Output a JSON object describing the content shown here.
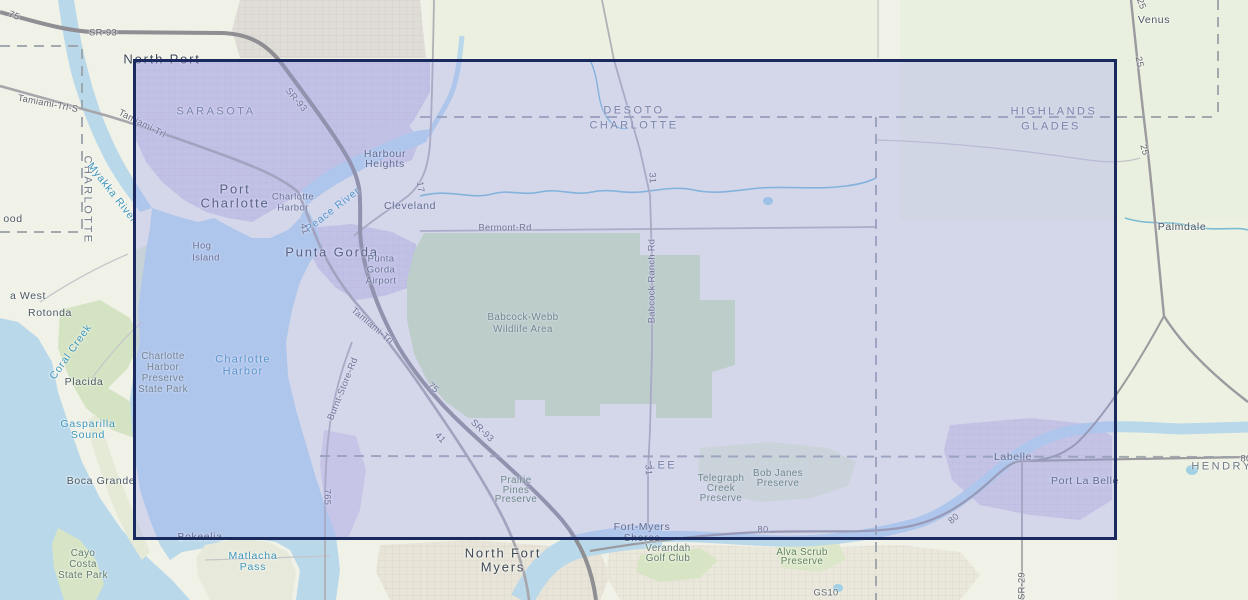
{
  "map": {
    "region": "Charlotte Harbor / Punta Gorda, Florida topographic basemap",
    "colors": {
      "land": "#f0f1e7",
      "water": "#b9d8ea",
      "stream": "#7bbcd4",
      "park_green": "#cfe2ba",
      "urban_purple": "#d5d1e3",
      "urban_tan": "#e8e5d8",
      "highway": "#8e8e93",
      "road": "#a6a6ab",
      "county_line": "#9aa2a8"
    }
  },
  "selection": {
    "x": 133,
    "y": 59,
    "width": 984,
    "height": 481,
    "fill": "rgba(150,155,240,0.30)",
    "border_color": "#1b2a5e"
  },
  "labels": [
    {
      "id": "county-sarasota",
      "text": "SARASOTA",
      "x": 216,
      "y": 112,
      "rot": 0,
      "cls": "county"
    },
    {
      "id": "county-desoto",
      "text": "DESOTO",
      "x": 634,
      "y": 111,
      "rot": 0,
      "cls": "county"
    },
    {
      "id": "county-charlotte",
      "text": "CHARLOTTE",
      "x": 634,
      "y": 126,
      "rot": 0,
      "cls": "county"
    },
    {
      "id": "county-highlands",
      "text": "HIGHLANDS",
      "x": 1054,
      "y": 112,
      "rot": 0,
      "cls": "county"
    },
    {
      "id": "county-glades",
      "text": "GLADES",
      "x": 1051,
      "y": 127,
      "rot": 0,
      "cls": "county"
    },
    {
      "id": "county-charlotte-vertical",
      "text": "CHARLOTTE",
      "x": 87,
      "y": 200,
      "rot": 90,
      "cls": "county"
    },
    {
      "id": "county-lee",
      "text": "LEE",
      "x": 663,
      "y": 466,
      "rot": 0,
      "cls": "county"
    },
    {
      "id": "county-hendry",
      "text": "HENDRY",
      "x": 1222,
      "y": 467,
      "rot": 0,
      "cls": "county"
    },
    {
      "id": "city-north-port",
      "text": "North Port",
      "x": 162,
      "y": 59,
      "rot": 0,
      "cls": "city-lg"
    },
    {
      "id": "city-port-charlotte-1",
      "text": "Port",
      "x": 235,
      "y": 189,
      "rot": 0,
      "cls": "city-lg"
    },
    {
      "id": "city-port-charlotte-2",
      "text": "Charlotte",
      "x": 235,
      "y": 203,
      "rot": 0,
      "cls": "city-lg"
    },
    {
      "id": "city-punta-gorda",
      "text": "Punta Gorda",
      "x": 332,
      "y": 252,
      "rot": 0,
      "cls": "city-lg"
    },
    {
      "id": "city-north-fort-myers-1",
      "text": "North Fort",
      "x": 503,
      "y": 553,
      "rot": 0,
      "cls": "city-lg"
    },
    {
      "id": "city-north-fort-myers-2",
      "text": "Myers",
      "x": 503,
      "y": 567,
      "rot": 0,
      "cls": "city-lg"
    },
    {
      "id": "town-harbour-heights-1",
      "text": "Harbour",
      "x": 385,
      "y": 154,
      "rot": 0,
      "cls": "town"
    },
    {
      "id": "town-harbour-heights-2",
      "text": "Heights",
      "x": 385,
      "y": 164,
      "rot": 0,
      "cls": "town"
    },
    {
      "id": "town-cleveland",
      "text": "Cleveland",
      "x": 410,
      "y": 206,
      "rot": 0,
      "cls": "town"
    },
    {
      "id": "town-charlotte-harbor-1",
      "text": "Charlotte",
      "x": 293,
      "y": 197,
      "rot": 0,
      "cls": "town-sm"
    },
    {
      "id": "town-charlotte-harbor-2",
      "text": "Harbor",
      "x": 293,
      "y": 208,
      "rot": 0,
      "cls": "town-sm"
    },
    {
      "id": "town-hog-island-1",
      "text": "Hog",
      "x": 202,
      "y": 246,
      "rot": 0,
      "cls": "town-sm"
    },
    {
      "id": "town-hog-island-2",
      "text": "Island",
      "x": 206,
      "y": 258,
      "rot": 0,
      "cls": "town-sm"
    },
    {
      "id": "town-pg-airport-1",
      "text": "Punta",
      "x": 381,
      "y": 259,
      "rot": 0,
      "cls": "town-sm"
    },
    {
      "id": "town-pg-airport-2",
      "text": "Gorda",
      "x": 381,
      "y": 270,
      "rot": 0,
      "cls": "town-sm"
    },
    {
      "id": "town-pg-airport-3",
      "text": "Airport",
      "x": 381,
      "y": 281,
      "rot": 0,
      "cls": "town-sm"
    },
    {
      "id": "town-rotonda-west-partial",
      "text": "a West",
      "x": 28,
      "y": 296,
      "rot": 0,
      "cls": "town"
    },
    {
      "id": "town-rotonda",
      "text": "Rotonda",
      "x": 50,
      "y": 313,
      "rot": 0,
      "cls": "town"
    },
    {
      "id": "town-placida",
      "text": "Placida",
      "x": 84,
      "y": 382,
      "rot": 0,
      "cls": "town"
    },
    {
      "id": "town-boca-grande",
      "text": "Boca Grande",
      "x": 101,
      "y": 481,
      "rot": 0,
      "cls": "town"
    },
    {
      "id": "town-bokeelia",
      "text": "Bokeelia",
      "x": 200,
      "y": 537,
      "rot": 0,
      "cls": "town"
    },
    {
      "id": "town-englewood-partial",
      "text": "ood",
      "x": 13,
      "y": 219,
      "rot": 0,
      "cls": "town"
    },
    {
      "id": "town-venus",
      "text": "Venus",
      "x": 1154,
      "y": 20,
      "rot": 0,
      "cls": "town"
    },
    {
      "id": "town-palmdale",
      "text": "Palmdale",
      "x": 1182,
      "y": 227,
      "rot": 0,
      "cls": "town"
    },
    {
      "id": "town-labelle",
      "text": "Labelle",
      "x": 1013,
      "y": 457,
      "rot": 0,
      "cls": "town"
    },
    {
      "id": "town-port-la-belle",
      "text": "Port La Belle",
      "x": 1085,
      "y": 481,
      "rot": 0,
      "cls": "town"
    },
    {
      "id": "town-fort-myers-shores-1",
      "text": "Fort-Myers",
      "x": 642,
      "y": 527,
      "rot": 0,
      "cls": "town"
    },
    {
      "id": "town-fort-myers-shores-2",
      "text": "Shores",
      "x": 642,
      "y": 538,
      "rot": 0,
      "cls": "town"
    },
    {
      "id": "park-babcock-webb-1",
      "text": "Babcock-Webb",
      "x": 523,
      "y": 318,
      "rot": 0,
      "cls": "park"
    },
    {
      "id": "park-babcock-webb-2",
      "text": "Wildlife Area",
      "x": 523,
      "y": 330,
      "rot": 0,
      "cls": "park"
    },
    {
      "id": "park-chps-1",
      "text": "Charlotte",
      "x": 163,
      "y": 357,
      "rot": 0,
      "cls": "park-gray"
    },
    {
      "id": "park-chps-2",
      "text": "Harbor",
      "x": 163,
      "y": 368,
      "rot": 0,
      "cls": "park-gray"
    },
    {
      "id": "park-chps-3",
      "text": "Preserve",
      "x": 163,
      "y": 379,
      "rot": 0,
      "cls": "park-gray"
    },
    {
      "id": "park-chps-4",
      "text": "State Park",
      "x": 163,
      "y": 390,
      "rot": 0,
      "cls": "park-gray"
    },
    {
      "id": "park-cayo-costa-1",
      "text": "Cayo",
      "x": 83,
      "y": 554,
      "rot": 0,
      "cls": "park-gray"
    },
    {
      "id": "park-cayo-costa-2",
      "text": "Costa",
      "x": 83,
      "y": 565,
      "rot": 0,
      "cls": "park-gray"
    },
    {
      "id": "park-cayo-costa-3",
      "text": "State Park",
      "x": 83,
      "y": 576,
      "rot": 0,
      "cls": "park-gray"
    },
    {
      "id": "park-telegraph-1",
      "text": "Telegraph",
      "x": 721,
      "y": 479,
      "rot": 0,
      "cls": "park"
    },
    {
      "id": "park-telegraph-2",
      "text": "Creek",
      "x": 721,
      "y": 489,
      "rot": 0,
      "cls": "park"
    },
    {
      "id": "park-telegraph-3",
      "text": "Preserve",
      "x": 721,
      "y": 499,
      "rot": 0,
      "cls": "park"
    },
    {
      "id": "park-bob-janes-1",
      "text": "Bob Janes",
      "x": 778,
      "y": 474,
      "rot": 0,
      "cls": "park"
    },
    {
      "id": "park-bob-janes-2",
      "text": "Preserve",
      "x": 778,
      "y": 484,
      "rot": 0,
      "cls": "park"
    },
    {
      "id": "park-prairie-pines-1",
      "text": "Prairie",
      "x": 516,
      "y": 481,
      "rot": 0,
      "cls": "park"
    },
    {
      "id": "park-prairie-pines-2",
      "text": "Pines",
      "x": 516,
      "y": 491,
      "rot": 0,
      "cls": "park"
    },
    {
      "id": "park-prairie-pines-3",
      "text": "Preserve",
      "x": 516,
      "y": 500,
      "rot": 0,
      "cls": "park"
    },
    {
      "id": "park-alva-scrub-1",
      "text": "Alva Scrub",
      "x": 802,
      "y": 553,
      "rot": 0,
      "cls": "park"
    },
    {
      "id": "park-alva-scrub-2",
      "text": "Preserve",
      "x": 802,
      "y": 562,
      "rot": 0,
      "cls": "park"
    },
    {
      "id": "park-verandah-1",
      "text": "Verandah",
      "x": 668,
      "y": 549,
      "rot": 0,
      "cls": "park-gray"
    },
    {
      "id": "park-verandah-2",
      "text": "Golf Club",
      "x": 668,
      "y": 559,
      "rot": 0,
      "cls": "park-gray"
    },
    {
      "id": "water-myakka-river",
      "text": "Myakka River",
      "x": 112,
      "y": 193,
      "rot": 52,
      "cls": "water"
    },
    {
      "id": "water-peace-river",
      "text": "Peace River",
      "x": 333,
      "y": 210,
      "rot": -38,
      "cls": "water"
    },
    {
      "id": "water-charlotte-harbor-1",
      "text": "Charlotte",
      "x": 243,
      "y": 360,
      "rot": 0,
      "cls": "water-lg"
    },
    {
      "id": "water-charlotte-harbor-2",
      "text": "Harbor",
      "x": 243,
      "y": 372,
      "rot": 0,
      "cls": "water-lg"
    },
    {
      "id": "water-gasparilla-1",
      "text": "Gasparilla",
      "x": 88,
      "y": 424,
      "rot": 0,
      "cls": "water"
    },
    {
      "id": "water-gasparilla-2",
      "text": "Sound",
      "x": 88,
      "y": 435,
      "rot": 0,
      "cls": "water"
    },
    {
      "id": "water-coral-creek",
      "text": "Coral Creek",
      "x": 71,
      "y": 352,
      "rot": -55,
      "cls": "water"
    },
    {
      "id": "water-matlacha-1",
      "text": "Matlacha",
      "x": 253,
      "y": 556,
      "rot": 0,
      "cls": "water"
    },
    {
      "id": "water-matlacha-2",
      "text": "Pass",
      "x": 253,
      "y": 567,
      "rot": 0,
      "cls": "water"
    },
    {
      "id": "route-75-nw",
      "text": "75",
      "x": 14,
      "y": 16,
      "rot": 22,
      "cls": "road"
    },
    {
      "id": "route-sr93-n",
      "text": "SR-93",
      "x": 103,
      "y": 33,
      "rot": 0,
      "cls": "road"
    },
    {
      "id": "route-sr93-diag",
      "text": "SR-93",
      "x": 296,
      "y": 100,
      "rot": 50,
      "cls": "road"
    },
    {
      "id": "route-tamiami-s",
      "text": "Tamiami-Trl-S",
      "x": 48,
      "y": 104,
      "rot": 11,
      "cls": "road"
    },
    {
      "id": "route-tamiami-1",
      "text": "Tamiami-Trl",
      "x": 142,
      "y": 124,
      "rot": 27,
      "cls": "road"
    },
    {
      "id": "route-17",
      "text": "17",
      "x": 420,
      "y": 187,
      "rot": 82,
      "cls": "road"
    },
    {
      "id": "route-41-n",
      "text": "41",
      "x": 304,
      "y": 229,
      "rot": 73,
      "cls": "road"
    },
    {
      "id": "route-bermont-rd",
      "text": "Bermont-Rd",
      "x": 505,
      "y": 228,
      "rot": 0,
      "cls": "road"
    },
    {
      "id": "route-31-n",
      "text": "31",
      "x": 652,
      "y": 178,
      "rot": 87,
      "cls": "road"
    },
    {
      "id": "route-babcock-ranch-rd",
      "text": "Babcock Ranch Rd",
      "x": 652,
      "y": 281,
      "rot": -90,
      "cls": "road"
    },
    {
      "id": "route-31-s",
      "text": "31",
      "x": 648,
      "y": 470,
      "rot": 87,
      "cls": "road"
    },
    {
      "id": "route-tamiami-2",
      "text": "Tamiami-Trl",
      "x": 372,
      "y": 326,
      "rot": 40,
      "cls": "road"
    },
    {
      "id": "route-75-s",
      "text": "75",
      "x": 433,
      "y": 388,
      "rot": 42,
      "cls": "road"
    },
    {
      "id": "route-sr93-s",
      "text": "SR-93",
      "x": 482,
      "y": 431,
      "rot": 44,
      "cls": "road"
    },
    {
      "id": "route-41-s",
      "text": "41",
      "x": 440,
      "y": 438,
      "rot": 47,
      "cls": "road"
    },
    {
      "id": "route-burnt-store-rd",
      "text": "Burnt-Store-Rd",
      "x": 343,
      "y": 389,
      "rot": -68,
      "cls": "road"
    },
    {
      "id": "route-765",
      "text": "765",
      "x": 327,
      "y": 497,
      "rot": 90,
      "cls": "road"
    },
    {
      "id": "route-80-w",
      "text": "80",
      "x": 763,
      "y": 530,
      "rot": 0,
      "cls": "road"
    },
    {
      "id": "route-80-diag",
      "text": "80",
      "x": 954,
      "y": 519,
      "rot": -42,
      "cls": "road"
    },
    {
      "id": "route-80-e",
      "text": "80",
      "x": 1246,
      "y": 459,
      "rot": 0,
      "cls": "road"
    },
    {
      "id": "route-sr29",
      "text": "SR-29",
      "x": 1022,
      "y": 586,
      "rot": -90,
      "cls": "road"
    },
    {
      "id": "route-25-top",
      "text": "25",
      "x": 1141,
      "y": 4,
      "rot": 70,
      "cls": "road"
    },
    {
      "id": "route-25-mid",
      "text": "25",
      "x": 1139,
      "y": 62,
      "rot": 78,
      "cls": "road"
    },
    {
      "id": "route-25-low",
      "text": "25",
      "x": 1144,
      "y": 150,
      "rot": 74,
      "cls": "road"
    },
    {
      "id": "route-gs10",
      "text": "GS10",
      "x": 826,
      "y": 593,
      "rot": 0,
      "cls": "road"
    }
  ]
}
